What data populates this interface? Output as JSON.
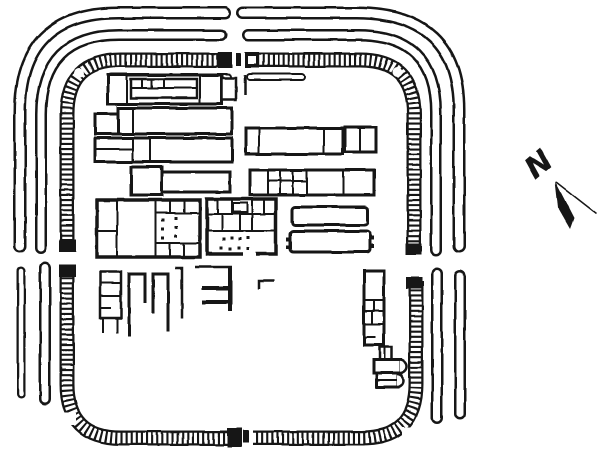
{
  "figure": {
    "background": "#ffffff",
    "ink": "#161616"
  },
  "compass": {
    "label": "N",
    "label_pos": [
      545,
      172
    ],
    "label_rotate": -40,
    "font_size": 30,
    "head_points": "555,181 574,218 570,229 558,208",
    "tail": [
      556,
      182,
      597,
      214
    ]
  },
  "plan": {
    "rampart_width": 15,
    "tick_width": 10.5,
    "tick_dash": "3 2.1",
    "ramparts": [
      {
        "name": "rampart-north-west",
        "d": "M 67,250 L 67,114 Q 67,60 121,60 L 220,60"
      },
      {
        "name": "rampart-north-east",
        "d": "M 249,60 L 360,60 Q 414,60 414,114 L 414,252"
      },
      {
        "name": "rampart-south-west",
        "d": "M 67,264 L 67,384 Q 67,438 121,438 L 228,438"
      },
      {
        "name": "rampart-south-east",
        "d": "M 253,438 L 362,438 Q 416,438 416,384 L 416,281"
      }
    ],
    "ditches": [
      {
        "name": "inner-ditch-north-west",
        "d": "M 41,248 L 41,114 Q 41,35 119,35 L 221,35",
        "wo": 12,
        "wi": 7
      },
      {
        "name": "inner-ditch-north-east",
        "d": "M 248,35 L 358,35 Q 436,35 436,112 L 436,250",
        "wo": 12,
        "wi": 7
      },
      {
        "name": "outer-ditch-north-west",
        "d": "M 20,246 L 20,112 Q 20,13 118,13 L 225,13",
        "wo": 13,
        "wi": 8
      },
      {
        "name": "outer-ditch-north-east",
        "d": "M 243,13 L 356,13 Q 459,13 459,110 L 459,246",
        "wo": 13,
        "wi": 8
      },
      {
        "name": "inner-ditch-south-west",
        "d": "M 45,268 L 45,399",
        "wo": 12,
        "wi": 7
      },
      {
        "name": "outer-ditch-south-west",
        "d": "M 21,271 L 21,394",
        "wo": 9,
        "wi": 4.5
      },
      {
        "name": "inner-ditch-south-east",
        "d": "M 437,273 L 437,418",
        "wo": 12,
        "wi": 7
      },
      {
        "name": "outer-ditch-south-east",
        "d": "M 460,276 L 460,414",
        "wo": 12,
        "wi": 7
      }
    ],
    "gate_blocks": [
      [
        218,
        52,
        14,
        16
      ],
      [
        245,
        52,
        14,
        16
      ],
      [
        59,
        239,
        17,
        13
      ],
      [
        59,
        264,
        17,
        13
      ],
      [
        227,
        428,
        15,
        19
      ],
      [
        406,
        243,
        16,
        12
      ],
      [
        406,
        277,
        16,
        12
      ]
    ],
    "gate_notches": [
      [
        248,
        56,
        8,
        8
      ]
    ],
    "gate_bars": [
      [
        236,
        53,
        5,
        13
      ],
      [
        243,
        430,
        6,
        13
      ]
    ],
    "towers": [
      {
        "shape": "circle",
        "cx": 79,
        "cy": 73,
        "r": 5
      },
      {
        "shape": "circle",
        "cx": 397,
        "cy": 72,
        "r": 5
      },
      {
        "shape": "rect",
        "x": 63,
        "y": 413,
        "w": 13,
        "h": 12
      },
      {
        "shape": "rect",
        "x": 402,
        "y": 427,
        "w": 10,
        "h": 10
      }
    ],
    "thin_bands": [
      {
        "name": "narrow-range-west",
        "d": "M 111,77 L 228,77",
        "wo": 8,
        "wi": 4
      },
      {
        "name": "narrow-range-east",
        "d": "M 250,77 L 302,77",
        "wo": 8,
        "wi": 4
      }
    ],
    "buildings": [
      {
        "name": "barrack-block-1",
        "rects": [
          [
            108,
            75,
            114,
            29,
            3
          ],
          [
            222,
            78,
            14,
            22,
            2.5
          ],
          [
            131,
            79,
            66,
            19,
            2.5
          ]
        ],
        "lines": [
          [
            127,
            75,
            127,
            104
          ],
          [
            200,
            75,
            200,
            104
          ],
          [
            142,
            79,
            142,
            88
          ],
          [
            152,
            79,
            152,
            88
          ],
          [
            164,
            79,
            164,
            88
          ],
          [
            131,
            88,
            197,
            88
          ]
        ]
      },
      {
        "name": "building-row2-west",
        "rects": [
          [
            95,
            114,
            23,
            20,
            3
          ],
          [
            118,
            108,
            114,
            26,
            3
          ]
        ],
        "lines": [
          [
            133,
            108,
            133,
            134
          ]
        ]
      },
      {
        "name": "building-row3-west",
        "rects": [
          [
            95,
            138,
            137,
            24,
            3
          ]
        ],
        "lines": [
          [
            95,
            149,
            133,
            149
          ],
          [
            133,
            138,
            133,
            162
          ],
          [
            150,
            138,
            150,
            162
          ]
        ]
      },
      {
        "name": "building-row4-west",
        "rects": [
          [
            131,
            167,
            31,
            28,
            3
          ],
          [
            162,
            172,
            68,
            20,
            3
          ]
        ]
      },
      {
        "name": "building-row2-east",
        "rects": [
          [
            246,
            128,
            97,
            26,
            3
          ],
          [
            345,
            127,
            31,
            25,
            3
          ]
        ],
        "lines": [
          [
            259,
            128,
            259,
            154
          ],
          [
            324,
            128,
            324,
            154
          ],
          [
            360,
            127,
            360,
            152
          ]
        ]
      },
      {
        "name": "building-row3-east",
        "rects": [
          [
            250,
            170,
            124,
            25,
            3
          ]
        ],
        "lines": [
          [
            268,
            170,
            268,
            195
          ],
          [
            280,
            170,
            280,
            195
          ],
          [
            293,
            170,
            293,
            195
          ],
          [
            307,
            170,
            307,
            195
          ],
          [
            343,
            170,
            343,
            195
          ],
          [
            268,
            181,
            307,
            181
          ]
        ]
      },
      {
        "name": "long-building-upper",
        "rects": [
          [
            292,
            207,
            76,
            18,
            3,
            3
          ]
        ]
      },
      {
        "name": "long-building-lower",
        "rects": [
          [
            290,
            231,
            80,
            21,
            3,
            3
          ]
        ],
        "tabs": [
          [
            286,
            237,
            5,
            4
          ],
          [
            286,
            245,
            5,
            4
          ],
          [
            369,
            236,
            5,
            4
          ],
          [
            369,
            244,
            5,
            4
          ]
        ]
      },
      {
        "name": "courtyard-building-west",
        "rects": [
          [
            97,
            200,
            103,
            57,
            3.5
          ]
        ],
        "lines": [
          [
            117,
            200,
            117,
            257
          ],
          [
            97,
            231,
            117,
            231
          ],
          [
            156,
            200,
            156,
            257
          ],
          [
            156,
            213,
            200,
            213
          ],
          [
            156,
            243,
            200,
            243
          ],
          [
            170,
            200,
            170,
            213
          ],
          [
            184,
            200,
            184,
            213
          ],
          [
            170,
            243,
            170,
            257
          ],
          [
            184,
            243,
            184,
            257
          ]
        ],
        "dots": [
          [
            163,
            220
          ],
          [
            163,
            229
          ],
          [
            163,
            238
          ],
          [
            176,
            218
          ],
          [
            176,
            227
          ],
          [
            176,
            236
          ]
        ]
      },
      {
        "name": "courtyard-building-east",
        "rects": [
          [
            207,
            199,
            69,
            55,
            3.5
          ],
          [
            233,
            203,
            14,
            9,
            2
          ]
        ],
        "lines": [
          [
            207,
            214,
            276,
            214
          ],
          [
            207,
            231,
            276,
            231
          ],
          [
            218,
            199,
            218,
            214
          ],
          [
            232,
            199,
            232,
            214
          ],
          [
            252,
            199,
            252,
            231
          ],
          [
            264,
            199,
            264,
            214
          ],
          [
            222,
            214,
            222,
            231
          ],
          [
            240,
            214,
            240,
            231
          ]
        ],
        "dots": [
          [
            224,
            239
          ],
          [
            232,
            238
          ],
          [
            240,
            239
          ],
          [
            248,
            238
          ],
          [
            221,
            248
          ],
          [
            230,
            249
          ],
          [
            239,
            248
          ],
          [
            248,
            249
          ]
        ],
        "white": [
          [
            243,
            251,
            13,
            5
          ]
        ]
      },
      {
        "name": "fragment-building-a",
        "rects": [
          [
            100,
            272,
            21,
            46,
            2.5
          ]
        ],
        "lines": [
          [
            100,
            283,
            121,
            283
          ],
          [
            100,
            296,
            121,
            296
          ],
          [
            100,
            308,
            111,
            308
          ],
          [
            103,
            318,
            103,
            333
          ],
          [
            117,
            318,
            117,
            333
          ]
        ]
      },
      {
        "name": "strip-building-east",
        "rects": [
          [
            364,
            271,
            20,
            74,
            3
          ]
        ],
        "lines": [
          [
            364,
            300,
            384,
            300
          ],
          [
            364,
            311,
            384,
            311
          ],
          [
            364,
            324,
            384,
            324
          ],
          [
            374,
            300,
            374,
            311
          ],
          [
            372,
            311,
            372,
            324
          ],
          [
            364,
            337,
            376,
            337
          ]
        ]
      },
      {
        "name": "apsidal-building",
        "rects": [
          [
            380,
            347,
            12,
            13,
            2.5
          ],
          [
            374,
            360,
            27,
            13,
            3
          ],
          [
            377,
            373,
            21,
            14,
            3
          ]
        ],
        "lines": [
          [
            385,
            347,
            385,
            360
          ],
          [
            377,
            380,
            397,
            380
          ]
        ],
        "paths": [
          {
            "d": "M 400,360 A 7,6.5 0 0 1 400,373",
            "w": 2.5
          },
          {
            "d": "M 397,374 A 6.5,6.5 0 0 1 397,387",
            "w": 2.5
          }
        ]
      }
    ],
    "fragments": [
      {
        "d": "M 129,336 L 129,274 L 145,274 L 145,303",
        "w": 3
      },
      {
        "d": "M 153,313 L 153,274 L 168,274 L 168,331",
        "w": 3
      },
      {
        "d": "M 175,268 L 182,268 L 182,319",
        "w": 2.5
      },
      {
        "d": "M 195,267 L 232,267",
        "w": 2.5
      },
      {
        "d": "M 230,267 L 230,311",
        "w": 4
      },
      {
        "d": "M 202,288 L 230,288",
        "w": 4
      },
      {
        "d": "M 202,302 L 230,302",
        "w": 4
      },
      {
        "d": "M 259,289 L 259,281 L 274,281",
        "w": 2.5
      },
      {
        "d": "M 245,75 L 245,95",
        "w": 2.5
      }
    ]
  }
}
